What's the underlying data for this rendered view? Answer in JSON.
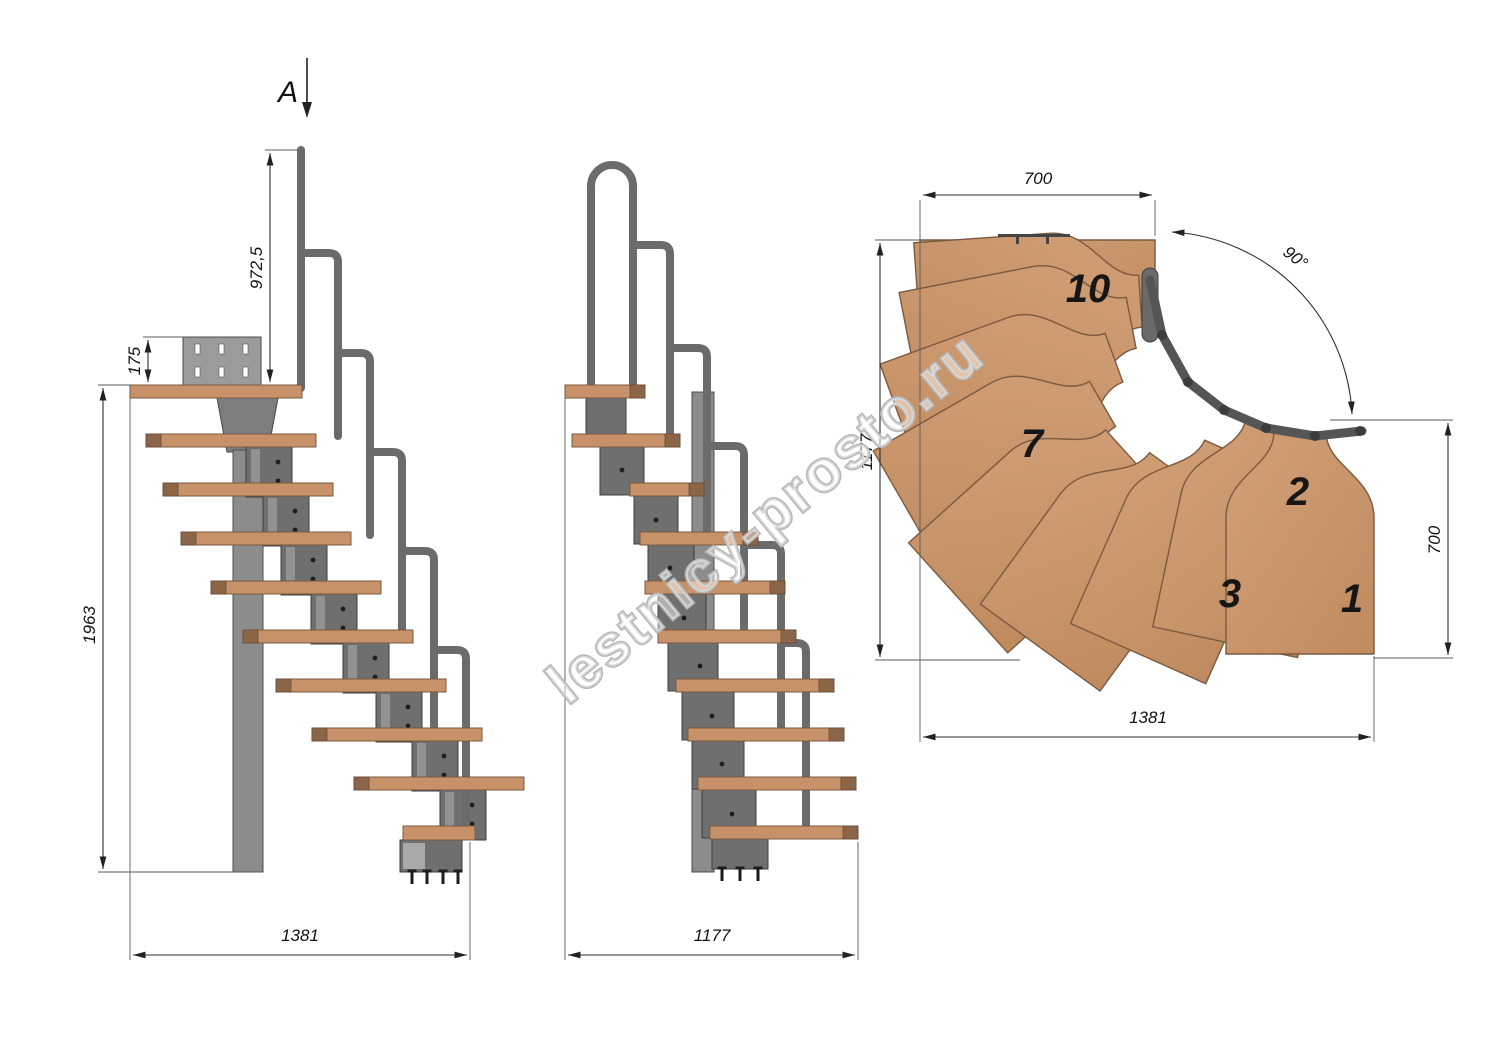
{
  "watermark": {
    "text": "lestnicy-prosto.ru"
  },
  "section_label": {
    "text": "A"
  },
  "side_view": {
    "dims": {
      "rail_height": "972,5",
      "plate_height": "175",
      "total_height": "1963",
      "length": "1381"
    }
  },
  "front_view": {
    "dims": {
      "width": "1177"
    }
  },
  "plan_view": {
    "dims": {
      "top_width": "700",
      "turn_angle": "90°",
      "left_depth": "1177",
      "right_depth": "700",
      "bottom_width": "1381"
    },
    "tread_numbers": [
      "10",
      "7",
      "3",
      "2",
      "1"
    ]
  },
  "colors": {
    "wood": "#c7916a",
    "wood_dark": "#8a6547",
    "metal": "#6f6f6f",
    "dimension_line": "#2e2e2e",
    "watermark_outline": "#b9b9b9",
    "background": "#ffffff"
  }
}
